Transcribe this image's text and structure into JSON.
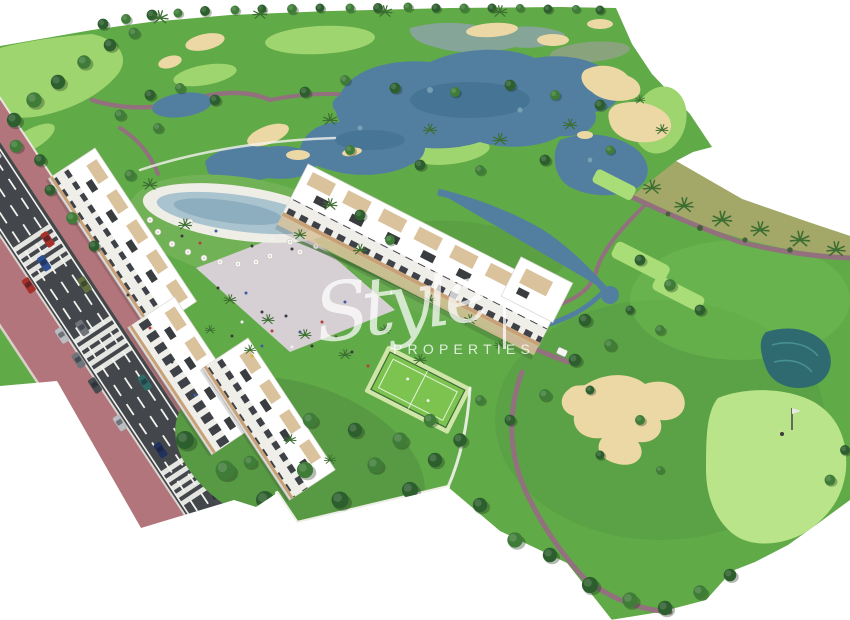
{
  "watermark": {
    "script_text": "Style",
    "caps_text": "PROPERTIES",
    "color": "#ffffff"
  },
  "colors": {
    "bg": "#ffffff",
    "grass": "#61aa48",
    "grass_dark": "#4f9340",
    "grass_bright": "#6fbb52",
    "fairway_light": "#9fd56e",
    "green_putting": "#b9e489",
    "tee_light": "#a8dd77",
    "scrub": "#a3a869",
    "water": "#527fa0",
    "water_dark": "#3c6b8b",
    "water_light": "#7fa9bb",
    "pond_teal": "#2f6a70",
    "sand": "#ecd8a4",
    "path": "#92707d",
    "road": "#43474b",
    "road_line": "#f2f2ee",
    "sidewalk": "#b3757c",
    "curb": "#e9e5df",
    "building": "#ffffff",
    "building_shadow": "#d8d7d0",
    "window_dark": "#3e4248",
    "wood": "#c9a176",
    "terrace": "#d9c29c",
    "panel_dark": "#3a3d40",
    "pool_water": "#a9c4cf",
    "pool_deck": "#eeede6",
    "plaza": "#d6cfd3",
    "court_floor": "#7cc34f",
    "court_rim": "#cfe6a8",
    "tree_dark": "#2d5f2e",
    "tree_mid": "#3f7c38",
    "tree_light": "#5d9c49",
    "palm": "#3c6e31",
    "car_silver": "#b9bcc0",
    "car_red": "#a8302a",
    "car_blue": "#2d4f92",
    "car_olive": "#5f6f3e",
    "car_gray": "#70747a",
    "car_teal": "#2e6b66",
    "car_navy": "#22325f",
    "car_dark": "#474a4f",
    "cart_white": "#f5f5f2",
    "wall_white": "#f4f3ee",
    "watermark": "#ffffff"
  }
}
